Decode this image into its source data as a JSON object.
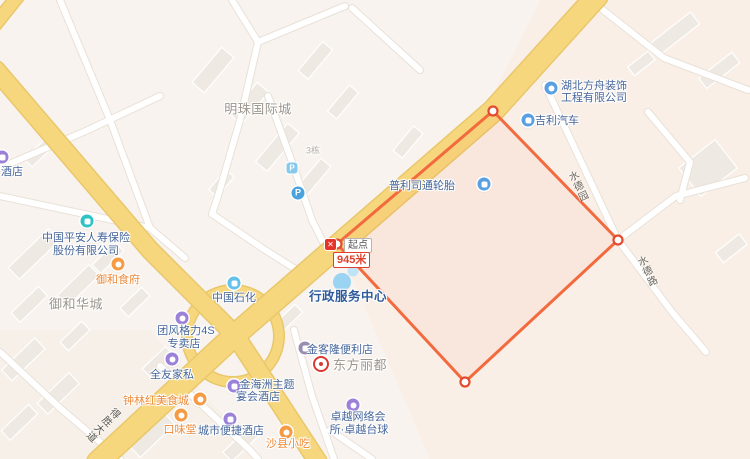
{
  "measurement": {
    "start_label": "起点",
    "distance_label": "945米",
    "close_glyph": "✕"
  },
  "parking": {
    "letter": "P"
  },
  "roads": {
    "desheng": "得胜大道",
    "shuideyuan": "水德园",
    "shuidelu": "水德路"
  },
  "areas": {
    "mingzhu": "明珠国际城",
    "yuhehuacheng": "御和华城",
    "dongfanglidu": "东方丽都",
    "building3": "3栋"
  },
  "pois": {
    "pingan": {
      "line1": "中国平安人寿保险",
      "line2": "股份有限公司",
      "icon": "insurance-icon"
    },
    "yuheshifu": {
      "name": "御和食府",
      "icon": "restaurant-icon"
    },
    "hoteledge": {
      "name": "酒店",
      "icon": "hotel-icon"
    },
    "shihua": {
      "name": "中国石化",
      "icon": "fuel-station-icon"
    },
    "xingzheng": {
      "name": "行政服务中心",
      "icon": "poi-dot-icon"
    },
    "pulisitong": {
      "name": "普利司通轮胎",
      "icon": "car-service-icon"
    },
    "fangzhou": {
      "line1": "湖北方舟装饰",
      "line2": "工程有限公司",
      "icon": "company-icon"
    },
    "jili": {
      "name": "吉利汽车",
      "icon": "car-dealer-icon"
    },
    "geli": {
      "line1": "团风格力4S",
      "line2": "专卖店",
      "icon": "store-icon"
    },
    "quanyou": {
      "name": "全友家私",
      "icon": "furniture-store-icon"
    },
    "zhonglinhong": {
      "name": "钟林红美食城",
      "icon": "food-icon"
    },
    "jinhaizhou": {
      "line1": "金海洲主题",
      "line2": "宴会酒店",
      "icon": "hotel-icon"
    },
    "kouweitang": {
      "name": "口味堂",
      "icon": "food-icon"
    },
    "chengshi": {
      "name": "城市便捷酒店",
      "icon": "hotel-icon"
    },
    "shaxian": {
      "name": "沙县小吃",
      "icon": "food-icon"
    },
    "jinkelong": {
      "name": "金客隆便利店",
      "icon": "convenience-store-icon"
    },
    "zhuoyue": {
      "line1": "卓越网络会",
      "line2": "所·卓越台球",
      "icon": "billiards-icon"
    }
  },
  "colors": {
    "background": "#f8f3ee",
    "district_tint": "#faefe7",
    "major_road_fill": "#f7d77d",
    "major_road_casing": "#e9c76b",
    "minor_road_casing": "#e8e1d8",
    "building_fill": "#eee9e2",
    "measure_line": "#f26a3d",
    "vertex_ring": "#e34b2e",
    "poi_text_blue": "#45669b",
    "poi_text_food": "#ed8a3a",
    "area_text_gray": "#9b958c"
  }
}
